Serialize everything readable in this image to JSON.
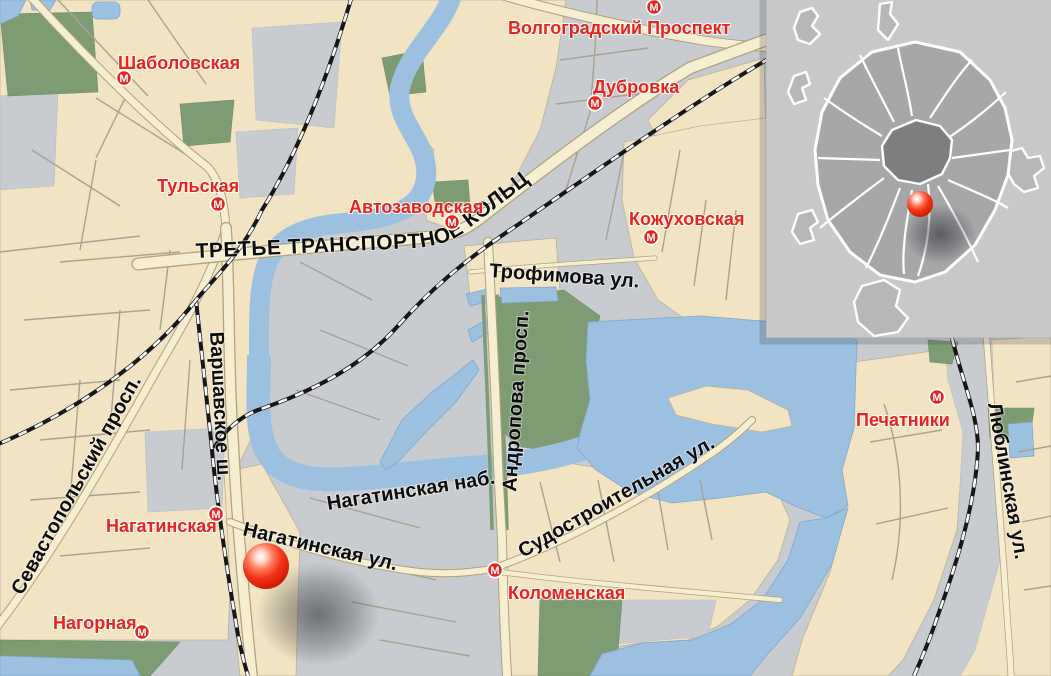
{
  "map": {
    "ttk_label": "ТРЕТЬЕ ТРАНСПОРТНОЕ КОЛЬЦО",
    "metro_symbol": "М",
    "colors": {
      "land_beige": "#F2E4C2",
      "land_gray": "#C8CCD0",
      "park_green": "#7E9C74",
      "water_blue": "#9CC1E0",
      "road_fill": "#F7EED2",
      "metro_red": "#E8251C",
      "marker_red": "#F03820"
    },
    "metro_stations": [
      {
        "name": "Шаболовская"
      },
      {
        "name": "Тульская"
      },
      {
        "name": "Автозаводская"
      },
      {
        "name": "Волгоградский Проспект"
      },
      {
        "name": "Дубровка"
      },
      {
        "name": "Кожуховская"
      },
      {
        "name": "Печатники"
      },
      {
        "name": "Нагатинская"
      },
      {
        "name": "Нагорная"
      },
      {
        "name": "Коломенская"
      }
    ],
    "streets": [
      {
        "name": "Трофимова ул."
      },
      {
        "name": "Варшавское ш."
      },
      {
        "name": "Севастопольский просп."
      },
      {
        "name": "Нагатинская наб."
      },
      {
        "name": "Нагатинская ул."
      },
      {
        "name": "Андропова просп."
      },
      {
        "name": "Судостроительная ул."
      },
      {
        "name": "Люблинская ул."
      }
    ]
  }
}
